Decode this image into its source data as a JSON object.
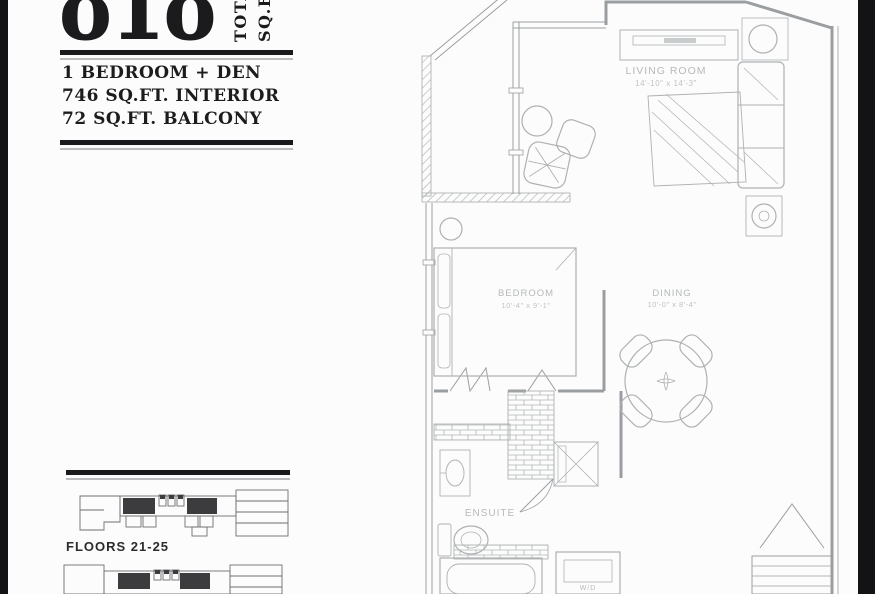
{
  "header": {
    "total_number": "818",
    "total_label_line1": "TOTAL",
    "total_label_line2": "SQ.FT.",
    "facts": [
      "1 BEDROOM + DEN",
      "746 SQ.FT. INTERIOR",
      "72 SQ.FT. BALCONY"
    ]
  },
  "floorplan": {
    "rooms": [
      {
        "name": "LIVING ROOM",
        "dims": "14'-10\" x 14'-3\""
      },
      {
        "name": "BEDROOM",
        "dims": "10'-4\" x 9'-1\""
      },
      {
        "name": "DINING",
        "dims": "10'-0\" x 8'-4\""
      },
      {
        "name": "ENSUITE",
        "dims": ""
      },
      {
        "name": "W/D",
        "dims": ""
      }
    ]
  },
  "keyplans": {
    "floors_label": "FLOORS 21-25"
  },
  "colors": {
    "ink": "#1b1b1d",
    "plan_wall": "#9b9ea0",
    "plan_furniture": "#aeb1b3",
    "plan_label": "#b6b9bb",
    "keyplan_line": "#6d6f71",
    "keyplan_highlight": "#3c3c3e",
    "page_bg": "#fcfcfc",
    "edge_band": "#131315"
  }
}
